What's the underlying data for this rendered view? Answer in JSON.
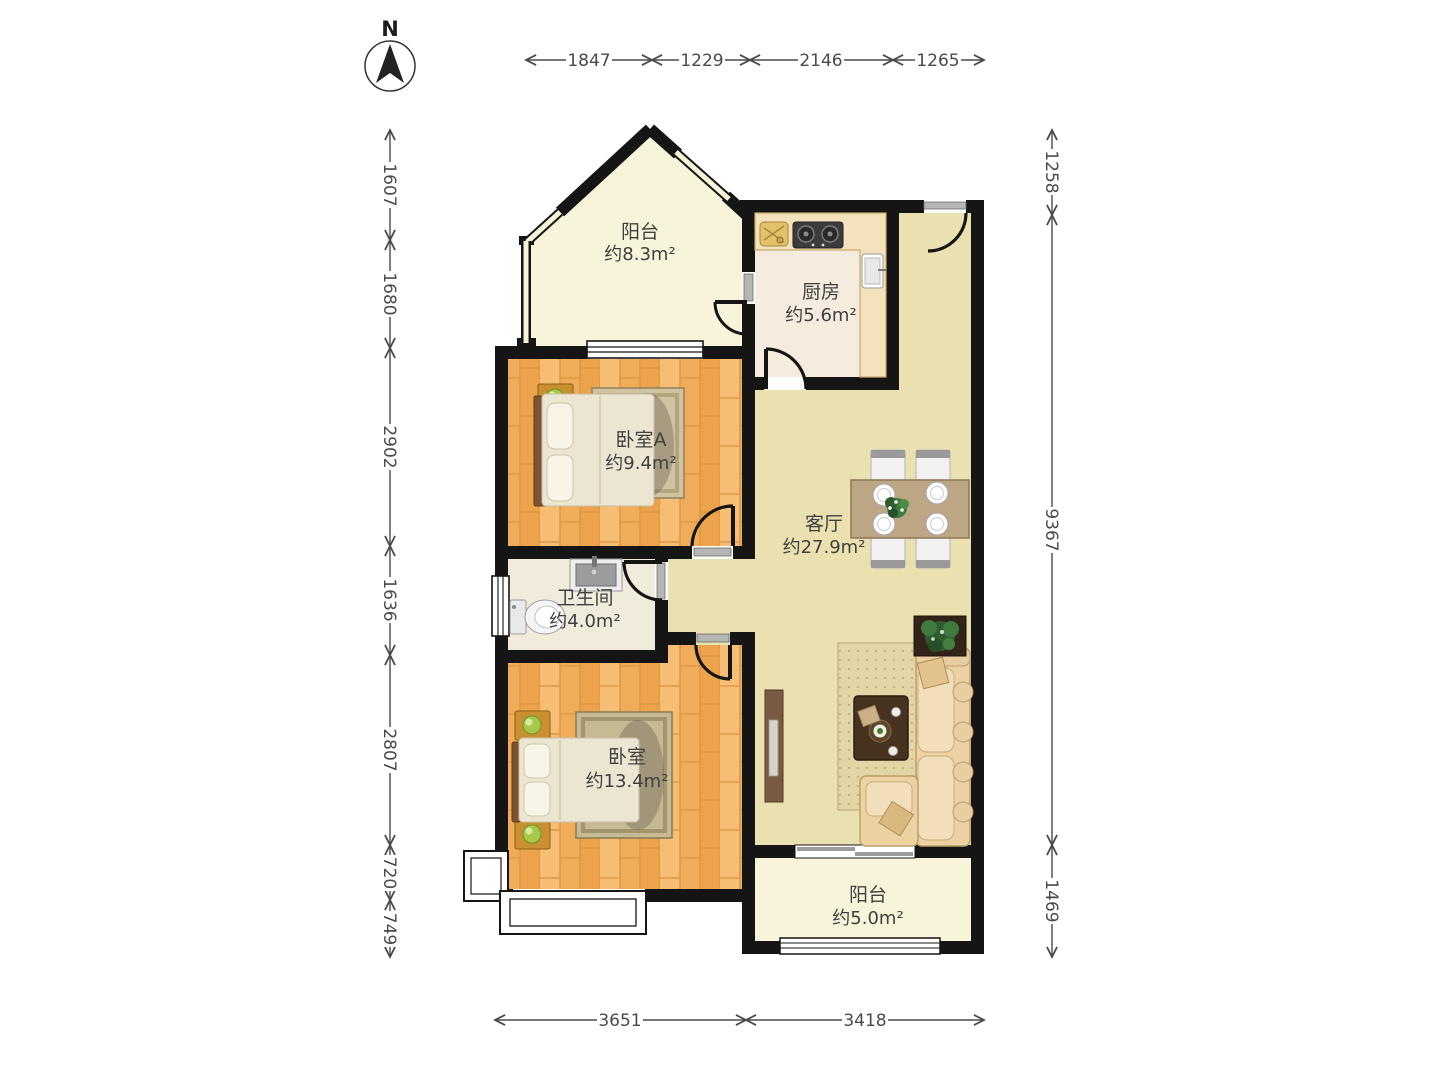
{
  "compass": {
    "label": "N"
  },
  "rooms": {
    "balcony_top": {
      "name": "阳台",
      "area": "约8.3m²"
    },
    "kitchen": {
      "name": "厨房",
      "area": "约5.6m²"
    },
    "bedroom_a": {
      "name": "卧室A",
      "area": "约9.4m²"
    },
    "living": {
      "name": "客厅",
      "area": "约27.9m²"
    },
    "bathroom": {
      "name": "卫生间",
      "area": "约4.0m²"
    },
    "bedroom": {
      "name": "卧室",
      "area": "约13.4m²"
    },
    "balcony_bottom": {
      "name": "阳台",
      "area": "约5.0m²"
    }
  },
  "dimensions": {
    "top": [
      "1847",
      "1229",
      "2146",
      "1265"
    ],
    "left": [
      "1607",
      "1680",
      "2902",
      "1636",
      "2807",
      "720",
      "749"
    ],
    "right": [
      "1258",
      "9367",
      "1469"
    ],
    "bottom": [
      "3651",
      "3418"
    ]
  },
  "colors": {
    "wall": "#151515",
    "wood_floor": "#f2b166",
    "living_floor": "#eae0b0",
    "balcony_floor": "#f8f4da",
    "kitchen_floor": "#f5ecdf",
    "bath_floor": "#f1ebdc",
    "label_text": "#3f3f3f",
    "dimension_text": "#4a4a4a"
  }
}
